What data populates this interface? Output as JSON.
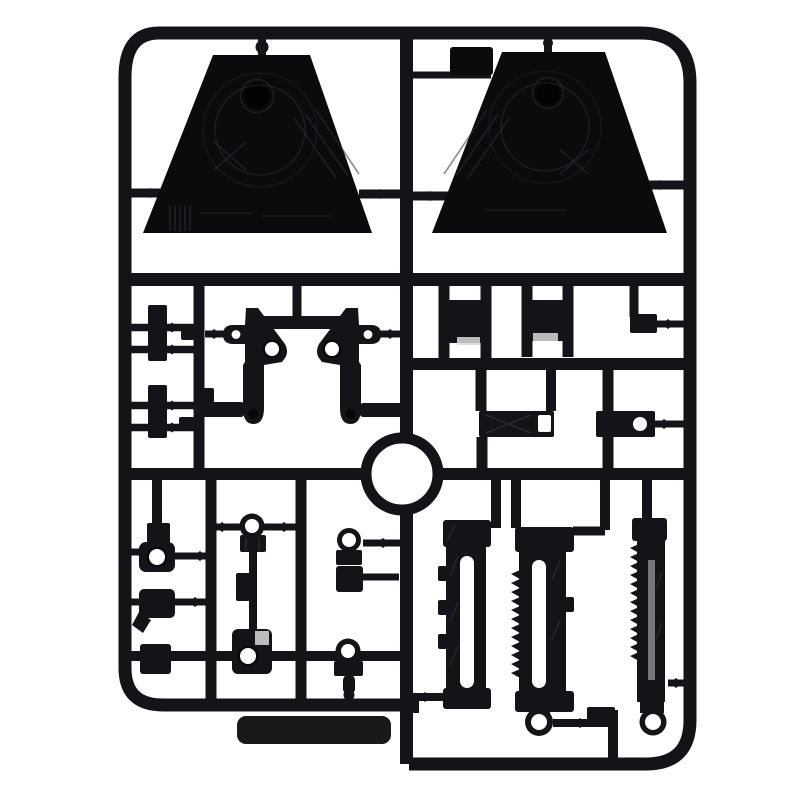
{
  "scene": {
    "type": "product-photo",
    "subject": "black plastic model-kit sprue runner with molded parts on a white background"
  },
  "colors": {
    "background": "#ffffff",
    "plastic": "#141418",
    "plastic_deep": "#0b0b0e",
    "hole_dark": "#030305",
    "outline": "#050507",
    "panel_line": "#2e2e35",
    "hole": "#ffffff",
    "reflection": "#d8d8d8",
    "shadow_band": "#121212"
  },
  "parts": {
    "frame": "rounded rectangular runner frame",
    "trapezoid_left": "large trapezoid panel part (top left)",
    "trapezoid_right": "large trapezoid panel part (top right)",
    "small_tab": "small flat tab part near top",
    "ring": "circular ring part at center",
    "bracket_left": "angled bracket with pivot holes",
    "bracket_right": "mirrored angled bracket with pivot holes",
    "socket_blocks": "two square socket blocks",
    "slotted_plate": "rectangular plate with slot",
    "holed_plate": "rectangular plate with round hole",
    "knuckle_cluster": "small hinge knuckle parts with round holes",
    "rail_long_left": "long slotted rail part",
    "rail_long_middle": "long ratcheted rail part with end ring",
    "rail_long_right": "long toothed rail part with end ring",
    "shadow_strip": "dark strip visible under lower edge of frame"
  },
  "counts": {
    "large_trapezoid_panels": 2,
    "long_rail_parts": 3,
    "ring_parts": 1,
    "square_socket_parts": 2
  }
}
